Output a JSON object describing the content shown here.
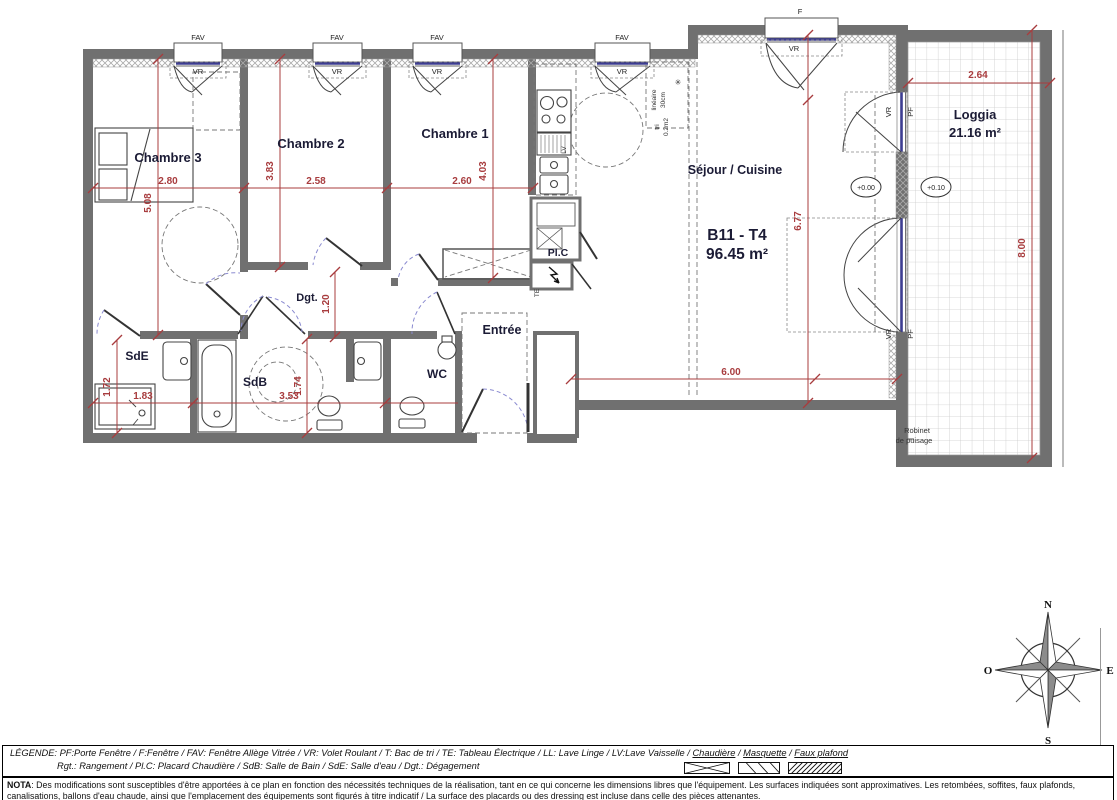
{
  "plan": {
    "unit_code": "B11 - T4",
    "unit_area": "96.45 m²",
    "rooms": {
      "chambre1": "Chambre 1",
      "chambre2": "Chambre 2",
      "chambre3": "Chambre 3",
      "sejour": "Séjour / Cuisine",
      "loggia": "Loggia",
      "loggia_area": "21.16 m²",
      "sde": "SdE",
      "sdb": "SdB",
      "wc": "WC",
      "entree": "Entrée",
      "dgt": "Dgt.",
      "plc": "Pl.C"
    },
    "dims": {
      "ch3_w": "2.80",
      "ch3_h": "5.08",
      "ch2_w": "2.58",
      "ch2_h": "3.83",
      "ch1_w": "2.60",
      "ch1_h": "4.03",
      "dgt_w": "1.20",
      "sejour_w": "6.00",
      "sejour_h": "6.77",
      "loggia_w": "2.64",
      "loggia_h": "8.00",
      "sde_h": "1.72",
      "sde_w": "1.83",
      "sdb_w": "3.53",
      "sdb_h": "1.74"
    },
    "levels": {
      "sejour": "+0.00",
      "loggia": "+0.10"
    },
    "window_labels": {
      "fav": "FAV",
      "f": "F",
      "vr": "VR",
      "pf": "PF"
    },
    "annotations": {
      "robinet_1": "Robinet",
      "robinet_2": "de puisage",
      "lineaire_1": "linéaire",
      "lineaire_2": "30cm",
      "tri_1": "tri",
      "tri_2": "0.2m2",
      "star": "✳",
      "lv": "LV",
      "te": "TE"
    },
    "compass": {
      "n": "N",
      "s": "S",
      "e": "E",
      "o": "O"
    }
  },
  "legend": {
    "prefix": "LÉGENDE: PF:Porte Fenêtre / F:Fenêtre / FAV: Fenêtre Allège Vitrée / VR: Volet Roulant / T: Bac de tri / TE: Tableau Électrique / LL: Lave Linge / LV:Lave Vaisselle / ",
    "chaudiere": "Chaudière",
    "sep1": " / ",
    "masquette": "Masquette",
    "sep2": " / ",
    "faux_plafond": "Faux plafond",
    "line2": "Rgt.: Rangement / Pl.C: Placard Chaudière / SdB: Salle de Bain / SdE: Salle d'eau / Dgt.: Dégagement"
  },
  "nota": {
    "label": "NOTA",
    "line1": ": Des modifications sont susceptibles d'être apportées à ce plan en fonction des nécessités techniques de la réalisation, tant en ce qui concerne les dimensions libres que l'équipement. Les surfaces indiquées sont approximatives. Les retombées, soffites, faux plafonds,",
    "line2": "canalisations, ballons d'eau chaude, ainsi que l'emplacement des équipements sont figurés à titre indicatif / La surface des placards ou des dressing est incluse dans celle des pièces attenantes."
  },
  "colors": {
    "wall": "#707070",
    "dimension": "#a83c3e",
    "glazing": "#3d3d91",
    "label": "#1b1b35",
    "door_arc": "#8a8ad0"
  }
}
